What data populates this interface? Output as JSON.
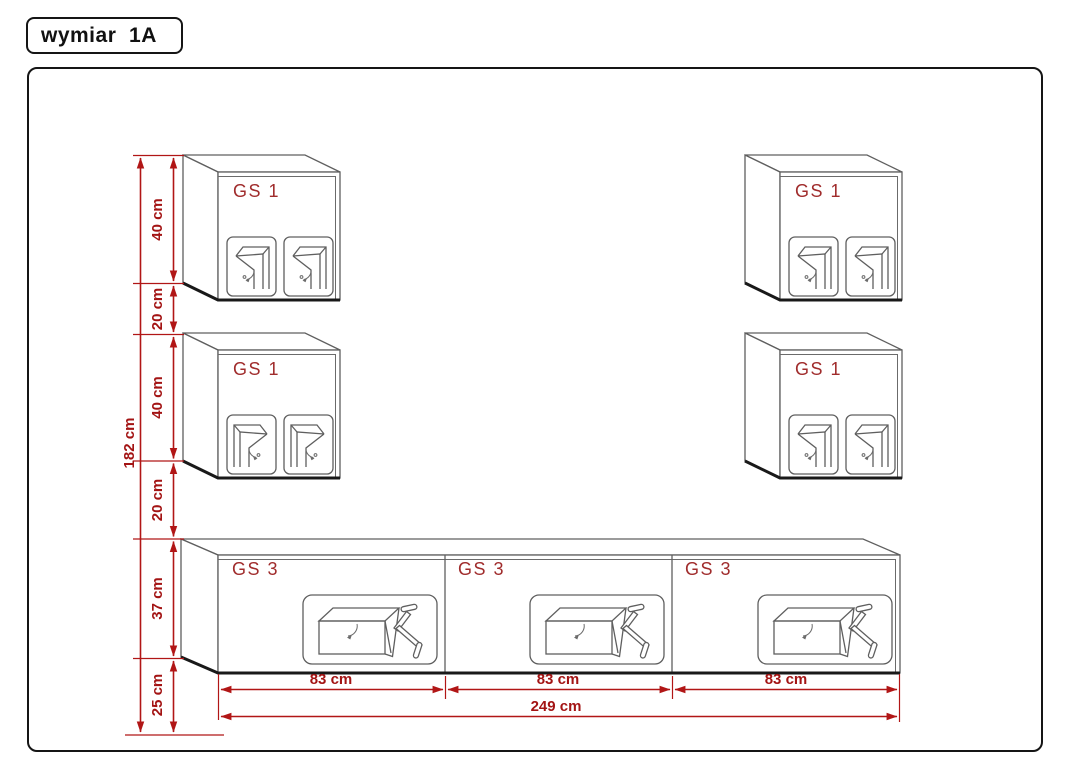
{
  "title_box": {
    "label": "wymiar  1A"
  },
  "units": {
    "wall_cabinets": [
      {
        "id": "top-left",
        "label": "GS 1"
      },
      {
        "id": "bottom-left",
        "label": "GS 1"
      },
      {
        "id": "top-right",
        "label": "GS 1"
      },
      {
        "id": "bottom-right",
        "label": "GS 1"
      }
    ],
    "tv_cabinet_segments": [
      {
        "id": "left",
        "label": "GS 3"
      },
      {
        "id": "center",
        "label": "GS 3"
      },
      {
        "id": "right",
        "label": "GS 3"
      }
    ]
  },
  "dimensions": {
    "vertical": {
      "total": "182 cm",
      "segments": [
        "40 cm",
        "20 cm",
        "40 cm",
        "20 cm",
        "37 cm",
        "25 cm"
      ]
    },
    "horizontal": {
      "total": "249 cm",
      "segments": [
        "83 cm",
        "83 cm",
        "83 cm"
      ]
    }
  },
  "icons": {
    "wall_cabinet_panel": "hinged-door-open-icon",
    "tv_cabinet_panel": "drop-down-flap-icon",
    "tv_cabinet_stay": "flap-stay-arm-icon"
  },
  "colors": {
    "dimension_red": "#b11616",
    "dimension_text_red": "#a31414",
    "unit_label_red": "#a02c2c",
    "outline_gray": "#5f5f5f",
    "outline_dark": "#191919"
  }
}
